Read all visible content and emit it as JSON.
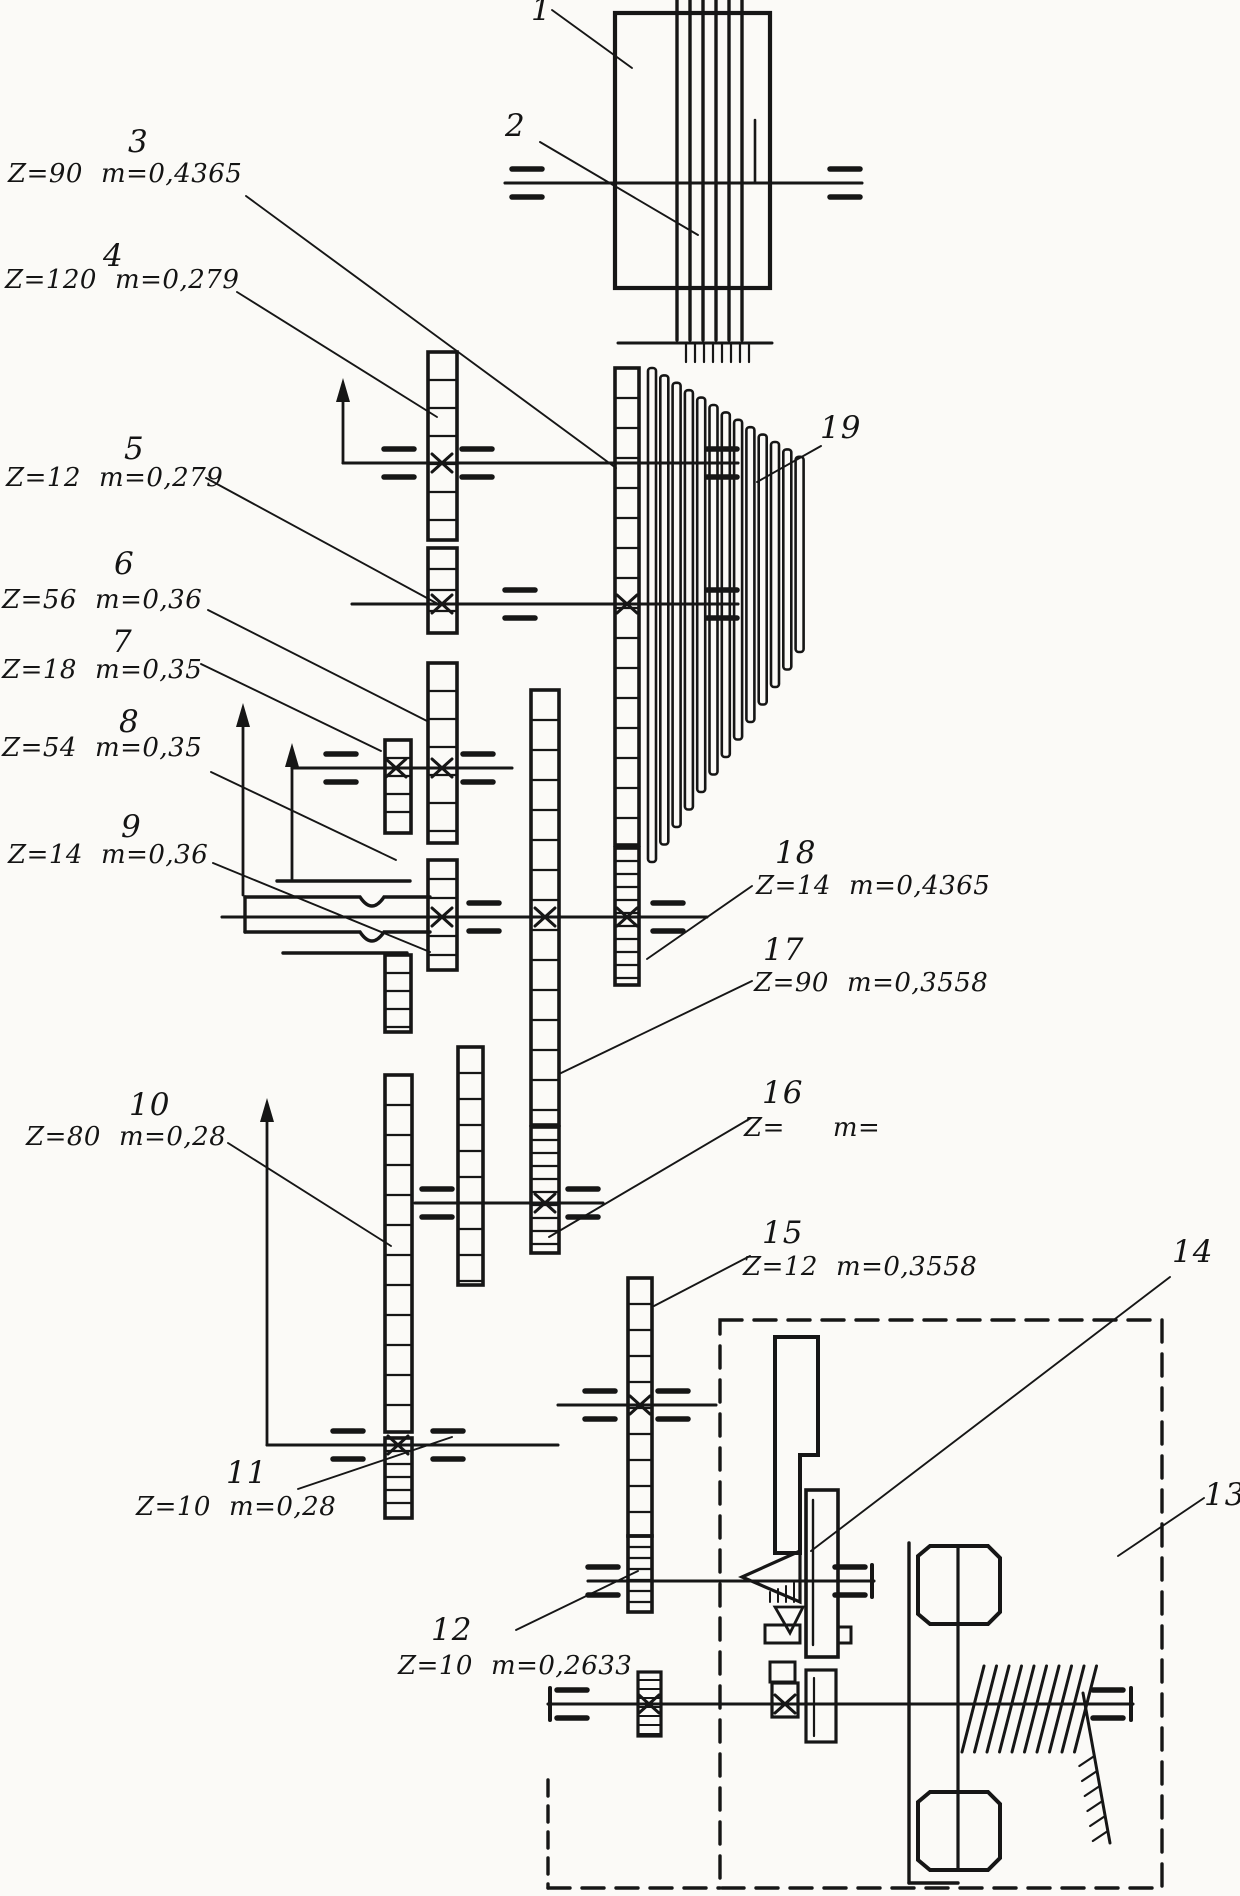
{
  "diagram": {
    "kind": "kinematic gear-train schematic",
    "colors": {
      "ink": "#161616",
      "paper": "#fbfaf7"
    },
    "parts": [
      {
        "num": "1",
        "z": "",
        "m": ""
      },
      {
        "num": "2",
        "z": "",
        "m": ""
      },
      {
        "num": "3",
        "z": "Z=90",
        "m": "m=0,4365"
      },
      {
        "num": "4",
        "z": "Z=120",
        "m": "m=0,279"
      },
      {
        "num": "5",
        "z": "Z=12",
        "m": "m=0,279"
      },
      {
        "num": "6",
        "z": "Z=56",
        "m": "m=0,36"
      },
      {
        "num": "7",
        "z": "Z=18",
        "m": "m=0,35"
      },
      {
        "num": "8",
        "z": "Z=54",
        "m": "m=0,35"
      },
      {
        "num": "9",
        "z": "Z=14",
        "m": "m=0,36"
      },
      {
        "num": "10",
        "z": "Z=80",
        "m": "m=0,28"
      },
      {
        "num": "11",
        "z": "Z=10",
        "m": "m=0,28"
      },
      {
        "num": "12",
        "z": "Z=10",
        "m": "m=0,2633"
      },
      {
        "num": "13",
        "z": "",
        "m": ""
      },
      {
        "num": "14",
        "z": "",
        "m": ""
      },
      {
        "num": "15",
        "z": "Z=12",
        "m": "m=0,3558"
      },
      {
        "num": "16",
        "z": "Z=",
        "m": "m="
      },
      {
        "num": "17",
        "z": "Z=90",
        "m": "m=0,3558"
      },
      {
        "num": "18",
        "z": "Z=14",
        "m": "m=0,4365"
      },
      {
        "num": "19",
        "z": "",
        "m": ""
      }
    ]
  }
}
